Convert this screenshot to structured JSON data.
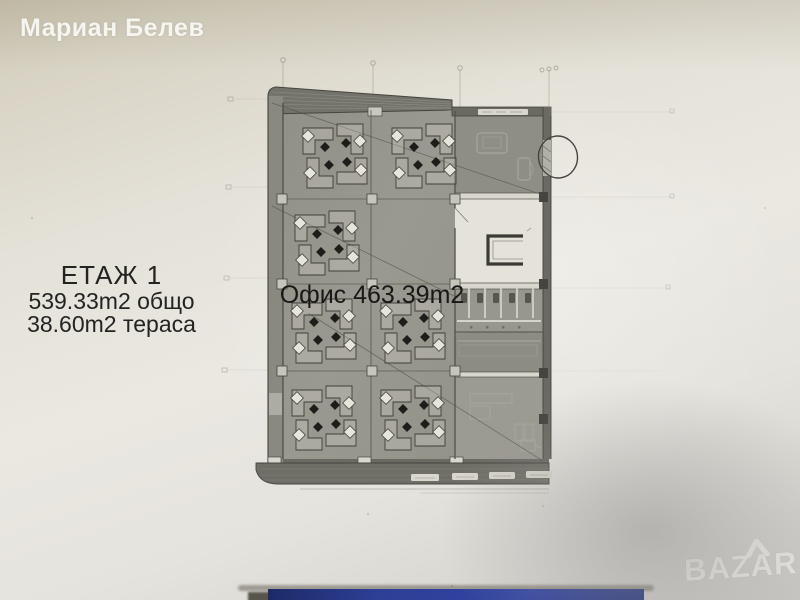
{
  "photo": {
    "seller_name": "Мариан Белев",
    "site_watermark": "BAZAR"
  },
  "annotations": {
    "floor_title": "ЕТАЖ 1",
    "total_area": "539.33m2 общо",
    "terrace_area": "38.60m2 тераса",
    "office_label": "Офис 463.39m2"
  },
  "plan": {
    "type": "architectural floor plan, first floor office layout",
    "desk_clusters": 7,
    "rooms": [
      "open office",
      "entrance room",
      "core with stair",
      "wc block",
      "service room",
      "office room"
    ],
    "highlight": "hand-drawn circle around entrance door on right wall"
  },
  "colors": {
    "paper": "#e8e6df",
    "plan_fill": "#95948b",
    "wall_ink": "#45443e",
    "annotation_ink": "#44433d",
    "blue_strip": "#2e3f97",
    "watermark_white": "#ebeae5"
  }
}
